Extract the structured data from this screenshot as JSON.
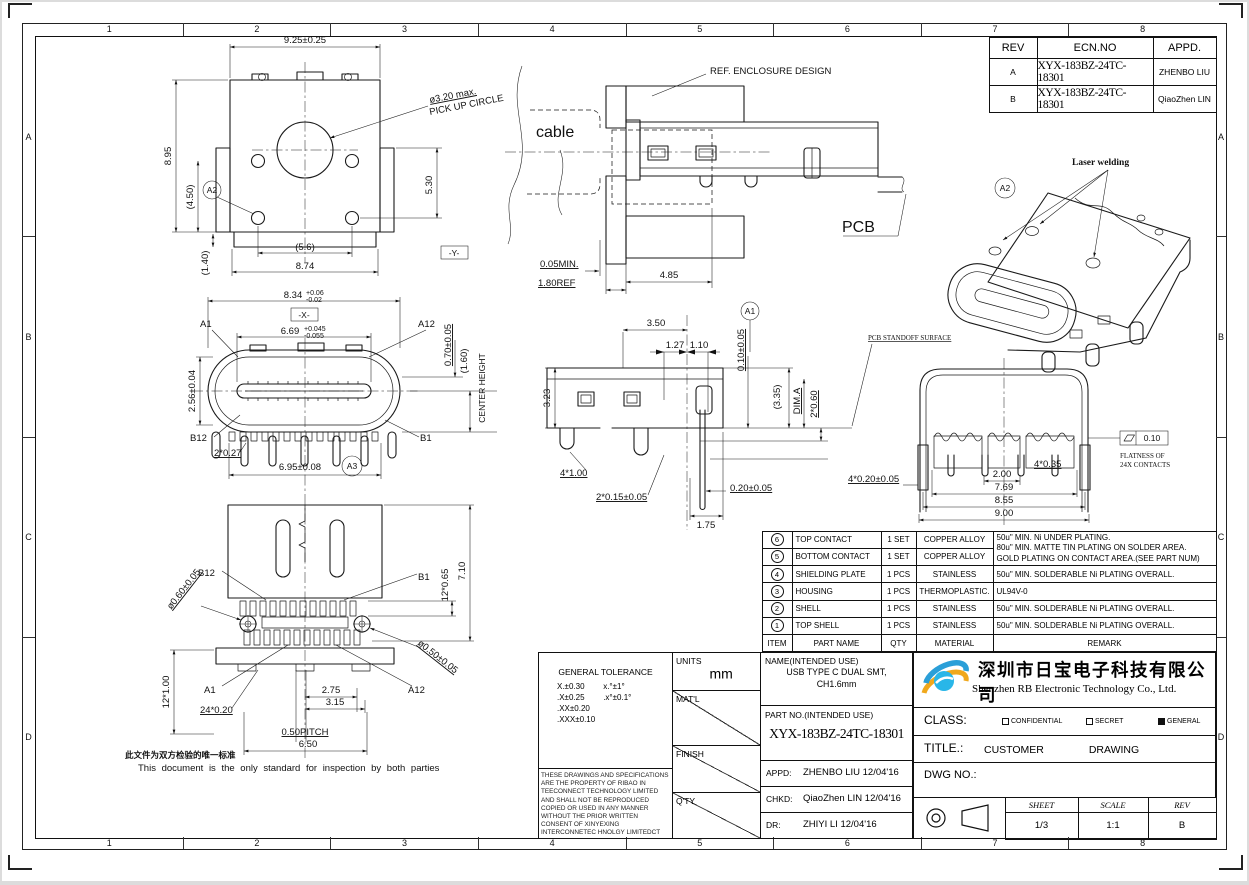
{
  "sheet": {
    "zones_h": [
      "1",
      "2",
      "3",
      "4",
      "5",
      "6",
      "7",
      "8"
    ],
    "zones_v": [
      "A",
      "B",
      "C",
      "D"
    ]
  },
  "rev_table": {
    "headers": {
      "rev": "REV",
      "ecn": "ECN.NO",
      "appd": "APPD."
    },
    "rows": [
      {
        "rev": "A",
        "ecn": "XYX-183BZ-24TC-18301",
        "appd": "ZHENBO LIU"
      },
      {
        "rev": "B",
        "ecn": "XYX-183BZ-24TC-18301",
        "appd": "QiaoZhen LIN"
      }
    ]
  },
  "views": {
    "top_view": {
      "dim_width": "9.25±0.25",
      "dim_height": "8.95",
      "dim_leg_v": "(4.50)",
      "dim_tail": "(1.40)",
      "balloon": "A2",
      "pickup_line1": "ø3.20 max.",
      "pickup_line2": "PICK UP CIRCLE",
      "dim_right": "5.30",
      "dim_leg_h": "(5.6)",
      "dim_base": "8.74",
      "datum": "-Y-"
    },
    "front_view": {
      "dim_shell": "8.34",
      "dim_shell_up": "+0.06",
      "dim_shell_dn": "-0.02",
      "datum": "-X-",
      "dim_tongue": "6.69",
      "dim_tongue_up": "+0.045",
      "dim_tongue_dn": "-0.055",
      "pin_a1": "A1",
      "pin_a12": "A12",
      "dim_tongue_h": "0.70±0.05",
      "dim_center": "(1.60)",
      "center_height": "CENTER HEIGHT",
      "dim_shell_h": "2.56±0.04",
      "pin_b12": "B12",
      "pin_b1": "B1",
      "dim_tab": "2*0.27",
      "dim_span": "6.95±0.08",
      "balloon": "A3"
    },
    "bottom_view": {
      "pin_b12": "B12",
      "pin_b1": "B1",
      "dim_depth": "7.10",
      "dim_pads": "12*0.65",
      "dim_hole1": "ø0.60±0.05",
      "dim_hole2": "ø0.50±0.05",
      "dim_legs": "12*1.00",
      "pin_a1": "A1",
      "pin_a12": "A12",
      "dim_275": "2.75",
      "dim_315": "3.15",
      "dim_tails": "24*0.20",
      "dim_pitch": "0.50PITCH",
      "dim_span": "6.50"
    },
    "app_view": {
      "enclosure": "REF. ENCLOSURE DESIGN",
      "cable": "cable",
      "pcb": "PCB",
      "dim_gap": "0.05MIN.",
      "dim_panel": "1.80REF",
      "dim_depth": "4.85"
    },
    "section_view": {
      "balloon": "A1",
      "dim_350": "3.50",
      "dim_127": "1.27",
      "dim_110": "1.10",
      "dim_offset": "0.10±0.05",
      "dim_height": "3.23",
      "dim_335": "(3.35)",
      "dim_a": "DIM.A",
      "dim_260": "2*0.60",
      "dim_4x1": "4*1.00",
      "dim_2x015": "2*0.15±0.05",
      "dim_020": "0.20±0.05",
      "dim_175": "1.75",
      "standoff": "PCB STANDOFF SURFACE"
    },
    "rear_view": {
      "dim_4x020": "4*0.20±0.05",
      "dim_200": "2.00",
      "dim_769": "7.69",
      "dim_855": "8.55",
      "dim_900": "9.00",
      "dim_4x035": "4*0.35",
      "flatness": "0.10",
      "flat_note1": "FLATNESS OF",
      "flat_note2": "24X CONTACTS"
    },
    "iso_view": {
      "balloon": "A2",
      "laser": "Laser welding"
    }
  },
  "parts_table": {
    "headers": {
      "item": "ITEM",
      "part_name": "PART NAME",
      "qty": "QTY",
      "material": "MATERIAL",
      "remark": "REMARK"
    },
    "contact_remark": {
      "line1": "50u\" MIN. Ni UNDER PLATING.",
      "line2": "80u\" MIN. MATTE TIN PLATING ON SOLDER AREA.",
      "line3": "GOLD PLATING ON CONTACT AREA.(SEE PART NUM)"
    },
    "rows": [
      {
        "item": "6",
        "part_name": "TOP CONTACT",
        "qty": "1 SET",
        "material": "COPPER ALLOY",
        "remark": ""
      },
      {
        "item": "5",
        "part_name": "BOTTOM CONTACT",
        "qty": "1 SET",
        "material": "COPPER ALLOY",
        "remark": ""
      },
      {
        "item": "4",
        "part_name": "SHIELDING PLATE",
        "qty": "1 PCS",
        "material": "STAINLESS",
        "remark": "50u\" MIN. SOLDERABLE Ni PLATING OVERALL."
      },
      {
        "item": "3",
        "part_name": "HOUSING",
        "qty": "1 PCS",
        "material": "THERMOPLASTIC.",
        "remark": "UL94V-0"
      },
      {
        "item": "2",
        "part_name": "SHELL",
        "qty": "1 PCS",
        "material": "STAINLESS",
        "remark": "50u\" MIN. SOLDERABLE Ni PLATING OVERALL."
      },
      {
        "item": "1",
        "part_name": "TOP SHELL",
        "qty": "1 PCS",
        "material": "STAINLESS",
        "remark": "50u\" MIN. SOLDERABLE Ni PLATING OVERALL."
      }
    ]
  },
  "title_block": {
    "general_tolerance": {
      "title": "GENERAL TOLERANCE",
      "rows": [
        [
          "X.±0.30",
          "x.°±1°"
        ],
        [
          ".X±0.25",
          ".x°±0.1°"
        ],
        [
          ".XX±0.20",
          ""
        ],
        [
          ".XXX±0.10",
          ""
        ]
      ]
    },
    "legal": "THESE DRAWINGS AND SPECIFICATIONS ARE THE PROPERTY OF RIBAO IN TEECONNECT TECHNOLOGY LIMITED AND SHALL NOT BE REPRODUCED COPIED OR USED IN ANY MANNER WITHOUT THE PRIOR WRITTEN CONSENT OF XINYEXING INTERCONNETEC HNOLGY LIMITEDCT",
    "units_label": "UNITS",
    "units_value": "mm",
    "matl_label": "MAT'L",
    "finish_label": "FINISH",
    "qty_label": "Q'TY",
    "name_label": "NAME(INTENDED USE)",
    "name_line1": "USB TYPE C DUAL SMT,",
    "name_line2": "CH1.6mm",
    "partno_label": "PART NO.(INTENDED USE)",
    "partno_value": "XYX-183BZ-24TC-18301",
    "appd_label": "APPD:",
    "appd_value": "ZHENBO LIU 12/04'16",
    "chkd_label": "CHKD:",
    "chkd_value": "QiaoZhen LIN 12/04'16",
    "dr_label": "DR:",
    "dr_value": "ZHIYI LI 12/04'16"
  },
  "company": {
    "name_cn": "深圳市日宝电子科技有限公司",
    "name_en": "Shenzhen RB Electronic Technology Co., Ltd.",
    "class_label": "CLASS:",
    "opt1": "CONFIDENTIAL",
    "opt2": "SECRET",
    "opt3": "GENERAL",
    "title_label": "TITLE.:",
    "title_word1": "CUSTOMER",
    "title_word2": "DRAWING",
    "dwg_label": "DWG NO.:",
    "sheet_label": "SHEET",
    "sheet_value": "1/3",
    "scale_label": "SCALE",
    "scale_value": "1:1",
    "rev_label": "REV",
    "rev_value": "B"
  },
  "footer_note": {
    "cn": "此文件为双方检验的唯一标准",
    "en": "This document is the only standard for inspection by both parties"
  }
}
